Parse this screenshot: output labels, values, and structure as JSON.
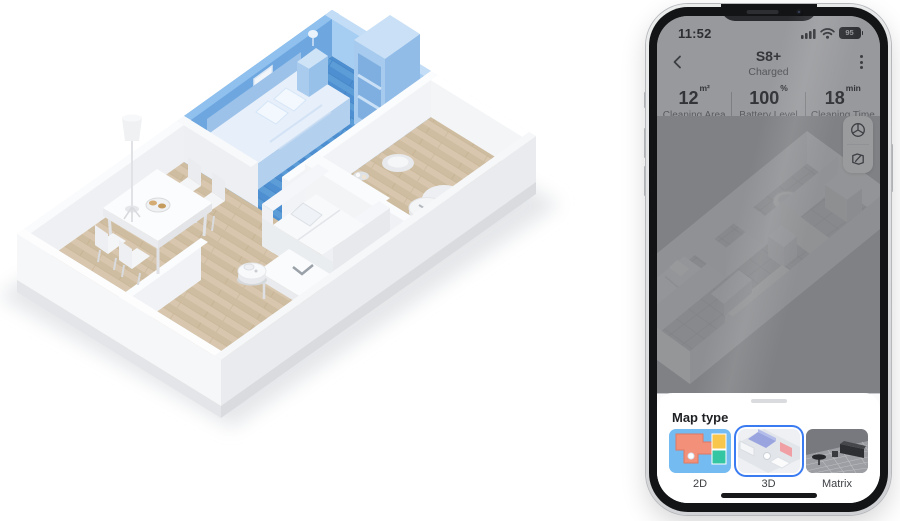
{
  "floorplan": {
    "highlight_color": "#4d8fd0",
    "highlighted_room": "bedroom"
  },
  "phone": {
    "status_bar": {
      "time": "11:52",
      "battery_level": "95"
    },
    "header": {
      "title": "S8+",
      "status": "Charged"
    },
    "stats": [
      {
        "value": "12",
        "unit": "m²",
        "label": "Cleaning Area"
      },
      {
        "value": "100",
        "unit": "%",
        "label": "Battery Level"
      },
      {
        "value": "18",
        "unit": "min",
        "label": "Cleaning Time"
      }
    ],
    "map_controls": [
      {
        "icon": "cube-3d"
      },
      {
        "icon": "map-edit"
      }
    ],
    "map_type_sheet": {
      "title": "Map type",
      "accent_color": "#3a7bf2",
      "options": [
        {
          "label": "2D",
          "selected": false
        },
        {
          "label": "3D",
          "selected": true
        },
        {
          "label": "Matrix",
          "selected": false
        }
      ],
      "thumb_colors": {
        "map2d": {
          "bg": "#74bbf1",
          "room1": "#f2907a",
          "room2": "#f7c64a",
          "room3": "#34c6a2"
        },
        "map3d": {
          "bg": "#eef0f3",
          "room": "#9aa5e0",
          "wall_accent": "#f0a0a4"
        },
        "matrix": {
          "bg": "#77797e",
          "floor": "#9c9ea3"
        }
      }
    },
    "icons": [
      "chevron-left",
      "kebab-menu",
      "signal",
      "wifi",
      "battery",
      "cube-3d",
      "map-edit",
      "drag-handle",
      "home-indicator"
    ]
  }
}
